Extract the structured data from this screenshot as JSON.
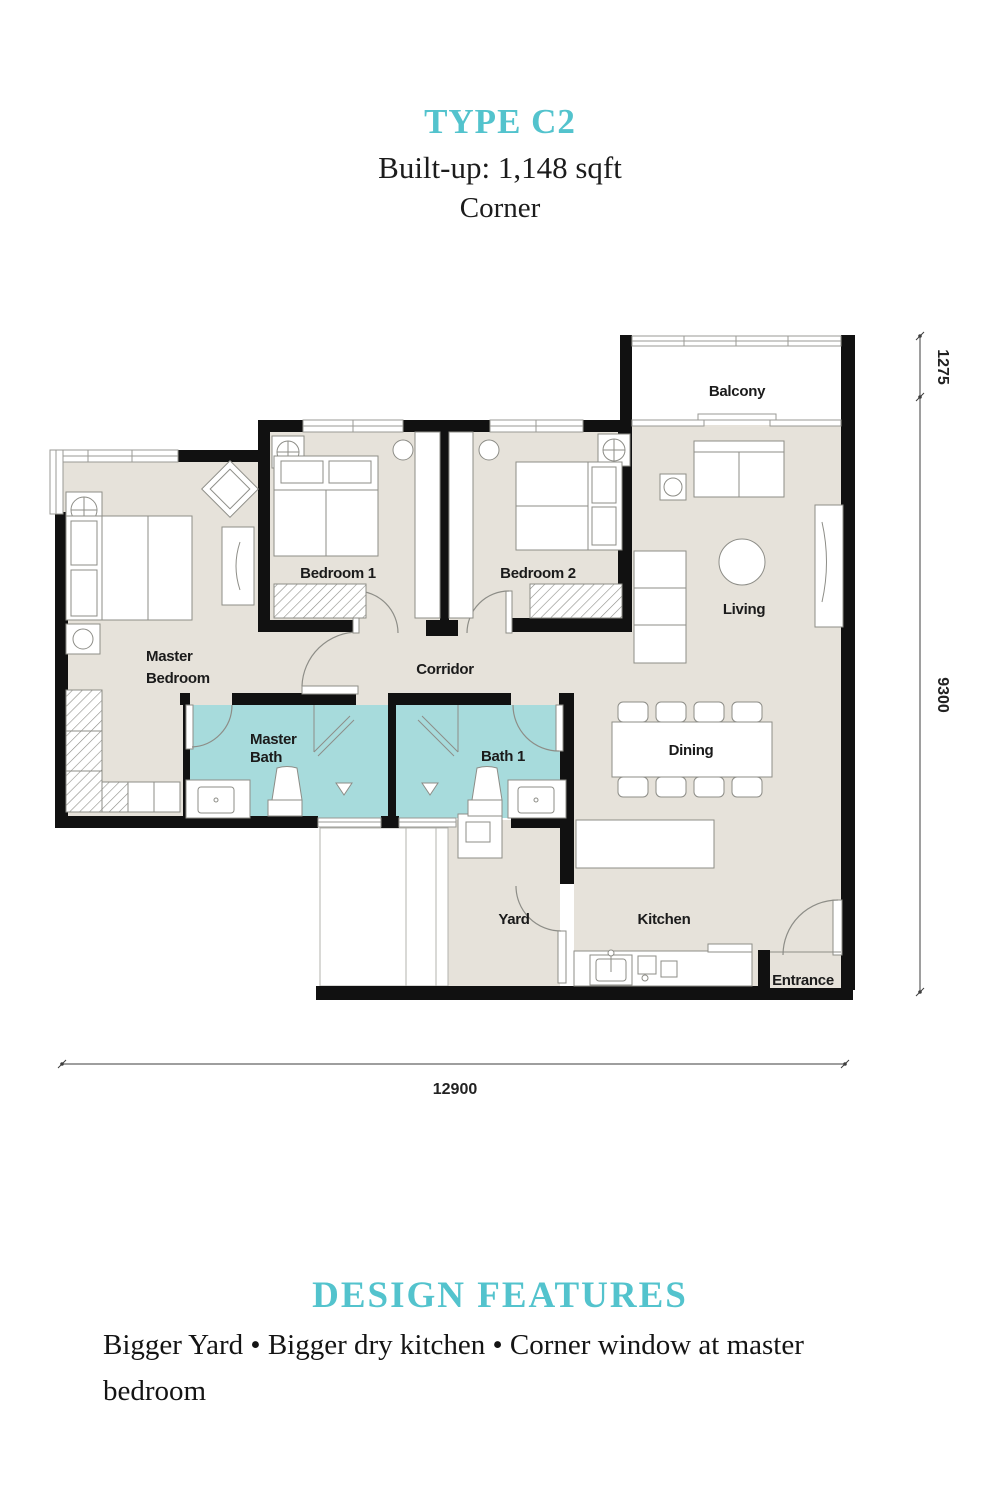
{
  "title": {
    "type": "TYPE C2",
    "builtup": "Built-up: 1,148 sqft",
    "position": "Corner"
  },
  "floorplan": {
    "rooms": {
      "balcony": "Balcony",
      "bedroom1": "Bedroom 1",
      "bedroom2": "Bedroom 2",
      "living": "Living",
      "master_bedroom_1": "Master",
      "master_bedroom_2": "Bedroom",
      "corridor": "Corridor",
      "master_bath_1": "Master",
      "master_bath_2": "Bath",
      "bath1": "Bath 1",
      "dining": "Dining",
      "yard": "Yard",
      "kitchen": "Kitchen",
      "entrance": "Entrance"
    },
    "dimensions": {
      "bottom_width": "12900",
      "right_main_height": "9300",
      "right_balcony_height": "1275"
    }
  },
  "design_features": {
    "heading": "DESIGN FEATURES",
    "text": "Bigger Yard • Bigger dry kitchen • Corner window at master bedroom"
  },
  "colors": {
    "accent_teal": "#53c3cd",
    "bath_fill": "#a7dbdc",
    "floor_fill": "#e6e2da",
    "wall": "#111111"
  }
}
